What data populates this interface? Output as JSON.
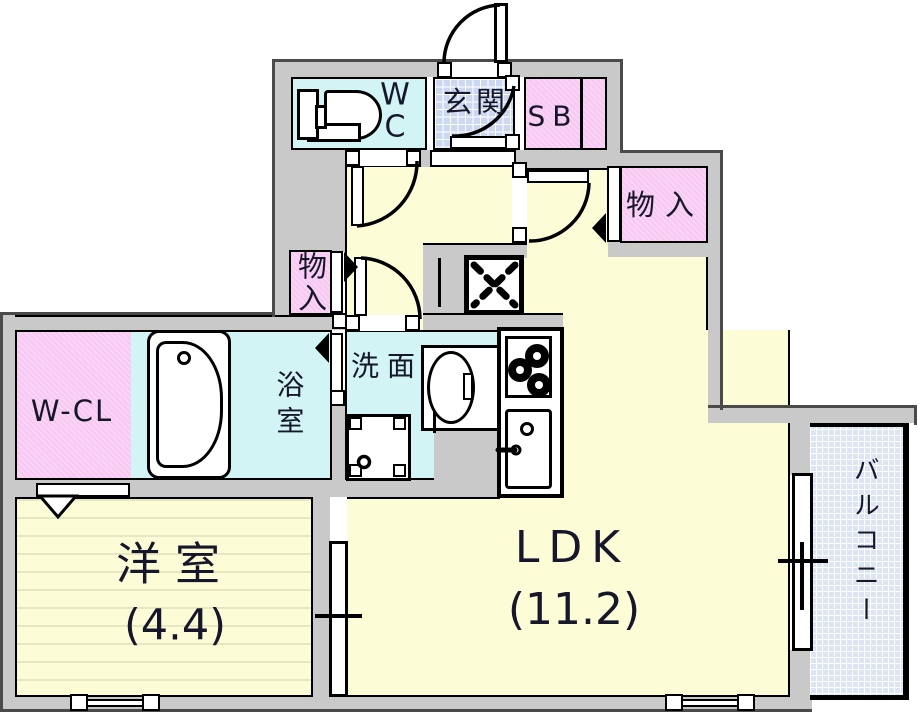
{
  "title": "apartment-floor-plan",
  "rooms": {
    "wc": {
      "line1": "W",
      "line2": "C"
    },
    "entrance": {
      "label": "玄関"
    },
    "shoe_box": {
      "label": "SB"
    },
    "storage_right": {
      "label": "物入"
    },
    "storage_left": {
      "label": "物入"
    },
    "washroom": {
      "label": "洗面"
    },
    "bathroom": {
      "label": "浴室"
    },
    "walk_in_closet": {
      "label": "W-CL"
    },
    "western_room": {
      "label": "洋室",
      "area": "(4.4)"
    },
    "ldk": {
      "label": "LDK",
      "area": "(11.2)"
    },
    "balcony": {
      "label": "バルコニー"
    }
  },
  "colors": {
    "wall": "#c9c9c9",
    "room_yellow": "#fcfcd6",
    "water_cyan": "#d2f4f4",
    "closet_pink": "#f7c9f3",
    "entrance_tile": "#ccd8f0",
    "balcony_tile": "#dbe5f5",
    "line": "#000000",
    "label_text": "#17172c"
  }
}
